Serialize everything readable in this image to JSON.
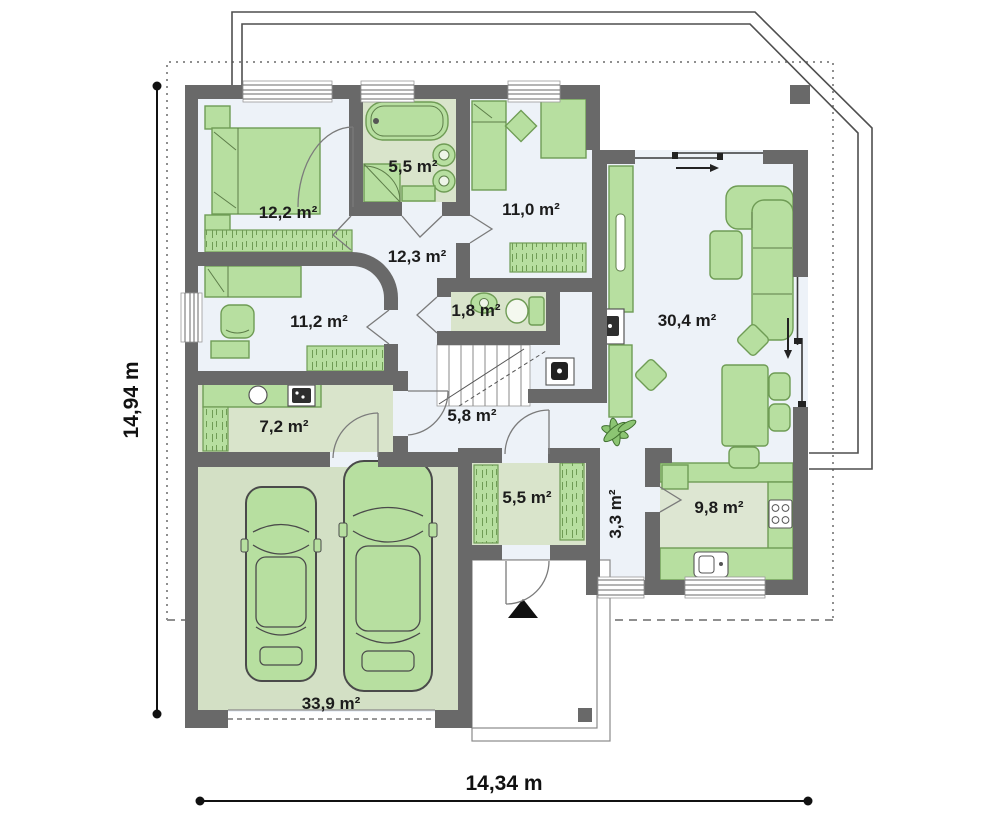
{
  "page": {
    "type": "floor-plan"
  },
  "dimensions": {
    "width_label": "14,34 m",
    "height_label": "14,94 m"
  },
  "rooms": [
    {
      "id": "bedroom-1",
      "area": "12,2 m²"
    },
    {
      "id": "bathroom",
      "area": "5,5 m²"
    },
    {
      "id": "bedroom-2",
      "area": "11,0 m²"
    },
    {
      "id": "corridor",
      "area": "12,3 m²"
    },
    {
      "id": "bedroom-3",
      "area": "11,2 m²"
    },
    {
      "id": "toilet",
      "area": "1,8 m²"
    },
    {
      "id": "living-room",
      "area": "30,4 m²"
    },
    {
      "id": "utility-room",
      "area": "7,2 m²"
    },
    {
      "id": "hall",
      "area": "5,8 m²"
    },
    {
      "id": "wardrobe",
      "area": "5,5 m²"
    },
    {
      "id": "pantry",
      "area": "3,3 m²"
    },
    {
      "id": "kitchen",
      "area": "9,8 m²"
    },
    {
      "id": "garage",
      "area": "33,9 m²"
    }
  ],
  "colors": {
    "wall": "#696969",
    "floor_main": "#edf2f8",
    "floor_service": "#d9e4cb",
    "floor_garage": "#d3e0c5",
    "floor_kitchen": "#dde6d2",
    "furniture": "#b7dfa0",
    "furniture_outline": "#6f9c55",
    "text": "#1c1c1c"
  }
}
